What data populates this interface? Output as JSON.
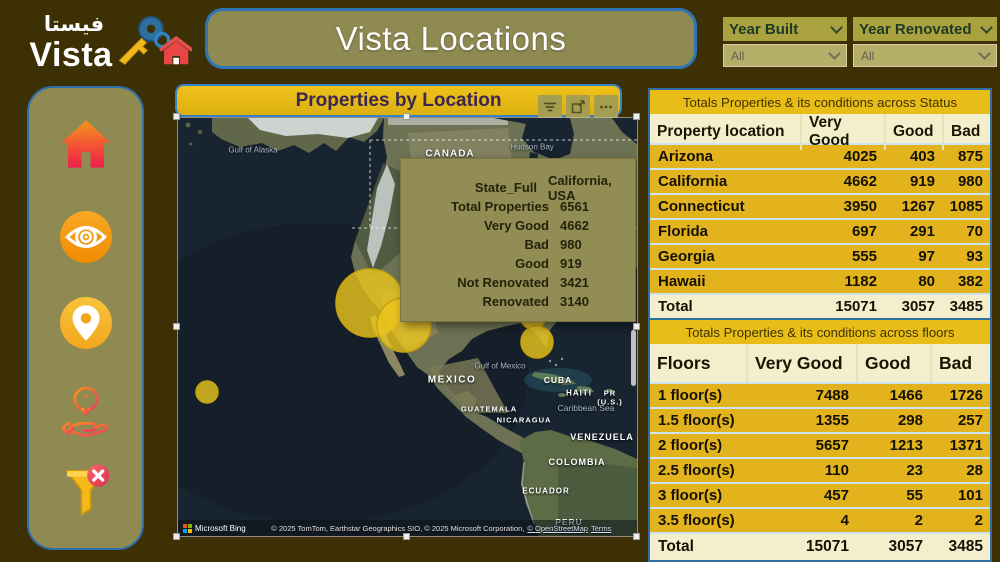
{
  "theme": {
    "background": "#3d3004",
    "panel_olive": "#8f8952",
    "accent_gold": "#e4b714",
    "accent_blue": "#2e75b6",
    "table_row_gold": "#e2b31d",
    "table_cream": "#f3eecb",
    "bubble_yellow": "#ecc71d"
  },
  "logo": {
    "arabic": "فيستا",
    "name": "Vista",
    "icon": "key-house-icon"
  },
  "header": {
    "title": "Vista Locations"
  },
  "slicers": [
    {
      "label": "Year Built",
      "value": "All"
    },
    {
      "label": "Year Renovated",
      "value": "All"
    }
  ],
  "sidebar": {
    "icons": [
      {
        "name": "home-icon"
      },
      {
        "name": "eye-icon"
      },
      {
        "name": "location-pin-icon"
      },
      {
        "name": "info-hand-icon"
      },
      {
        "name": "clear-filter-icon"
      }
    ]
  },
  "map": {
    "title": "Properties by Location",
    "header_icons": [
      {
        "name": "filter-icon"
      },
      {
        "name": "focus-mode-icon"
      },
      {
        "name": "more-options-icon"
      }
    ],
    "labels": [
      "Gulf of Alaska",
      "Hudson Bay",
      "CANADA",
      "MEXICO",
      "Gulf of Mexico",
      "CUBA",
      "HAITI",
      "PR (U.S.)",
      "Caribbean Sea",
      "GUATEMALA",
      "NICARAGUA",
      "VENEZUELA",
      "COLOMBIA",
      "ECUADOR",
      "PERU"
    ],
    "bubbles": [
      {
        "x": 192,
        "y": 185,
        "r": 34
      },
      {
        "x": 226,
        "y": 207,
        "r": 27
      },
      {
        "x": 355,
        "y": 198,
        "r": 13
      },
      {
        "x": 359,
        "y": 224,
        "r": 16
      },
      {
        "x": 29,
        "y": 274,
        "r": 11
      }
    ],
    "attribution": {
      "brand": "Microsoft Bing",
      "copyright": "© 2025 TomTom, Earthstar Geographics SIO, © 2025 Microsoft Corporation,",
      "osm_link": "© OpenStreetMap",
      "terms_link": "Terms"
    }
  },
  "tooltip": {
    "rows": [
      {
        "label": "State_Full",
        "value": "California, USA"
      },
      {
        "label": "Total Properties",
        "value": "6561"
      },
      {
        "label": "Very Good",
        "value": "4662"
      },
      {
        "label": "Bad",
        "value": "980"
      },
      {
        "label": "Good",
        "value": "919"
      },
      {
        "label": "Not Renovated",
        "value": "3421"
      },
      {
        "label": "Renovated",
        "value": "3140"
      }
    ]
  },
  "tables": {
    "status": {
      "title": "Totals Properties & its conditions across Status",
      "columns": [
        "Property location",
        "Very Good",
        "Good",
        "Bad"
      ],
      "rows": [
        [
          "Arizona",
          "4025",
          "403",
          "875"
        ],
        [
          "California",
          "4662",
          "919",
          "980"
        ],
        [
          "Connecticut",
          "3950",
          "1267",
          "1085"
        ],
        [
          "Florida",
          "697",
          "291",
          "70"
        ],
        [
          "Georgia",
          "555",
          "97",
          "93"
        ],
        [
          "Hawaii",
          "1182",
          "80",
          "382"
        ]
      ],
      "total": [
        "Total",
        "15071",
        "3057",
        "3485"
      ]
    },
    "floors": {
      "title": "Totals Properties & its conditions across floors",
      "columns": [
        "Floors",
        "Very Good",
        "Good",
        "Bad"
      ],
      "rows": [
        [
          "1 floor(s)",
          "7488",
          "1466",
          "1726"
        ],
        [
          "1.5 floor(s)",
          "1355",
          "298",
          "257"
        ],
        [
          "2 floor(s)",
          "5657",
          "1213",
          "1371"
        ],
        [
          "2.5 floor(s)",
          "110",
          "23",
          "28"
        ],
        [
          "3 floor(s)",
          "457",
          "55",
          "101"
        ],
        [
          "3.5 floor(s)",
          "4",
          "2",
          "2"
        ]
      ],
      "total": [
        "Total",
        "15071",
        "3057",
        "3485"
      ]
    }
  }
}
